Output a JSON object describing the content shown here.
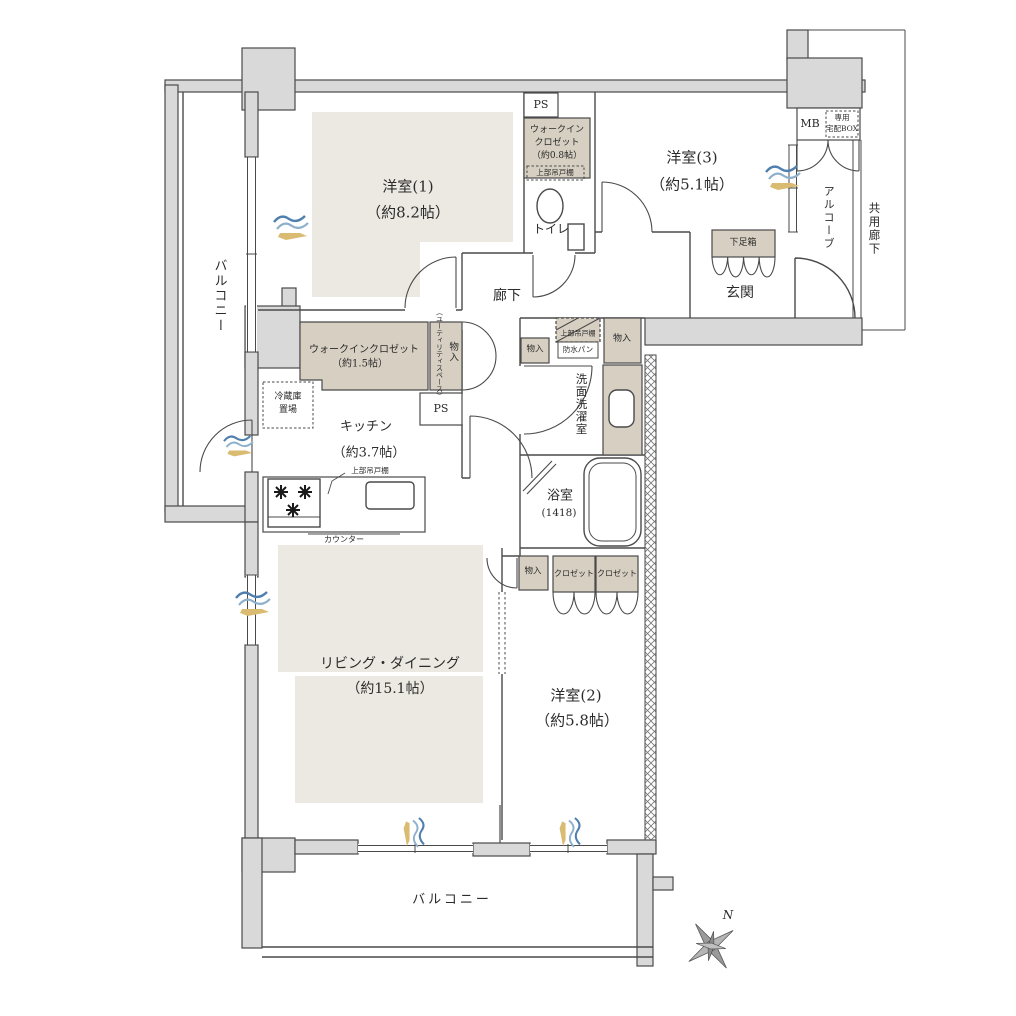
{
  "floorplan": {
    "balcony_left": "バルコニー",
    "balcony_bottom": "バルコニー",
    "yoshitsu1_name": "洋室(1)",
    "yoshitsu1_size": "（約8.2帖）",
    "yoshitsu2_name": "洋室(2)",
    "yoshitsu2_size": "（約5.8帖）",
    "yoshitsu3_name": "洋室(3)",
    "yoshitsu3_size": "（約5.1帖）",
    "living_name": "リビング・ダイニング",
    "living_size": "（約15.1帖）",
    "kitchen_name": "キッチン",
    "kitchen_size": "（約3.7帖）",
    "wic08_l1": "ウォークイン",
    "wic08_l2": "クロゼット",
    "wic08_l3": "（約0.8帖）",
    "wic15_l1": "ウォークインクロゼット",
    "wic15_l2": "（約1.5帖）",
    "toilet": "トイレ",
    "hallway": "廊下",
    "genkan": "玄関",
    "getabako": "下足箱",
    "washroom": "洗面洗濯室",
    "bath_name": "浴室",
    "bath_size": "(1418)",
    "ps_top": "PS",
    "ps_mid": "PS",
    "mb": "MB",
    "takuhai_l1": "専用",
    "takuhai_l2": "宅配BOX",
    "alcove": "アルコーブ",
    "shared_corridor": "共用廊下",
    "monoiri_utility": "物入",
    "utility_note": "（ユーティリティスペース）",
    "reizouko_l1": "冷蔵庫",
    "reizouko_l2": "置場",
    "shelf_toilet": "上部吊戸棚",
    "shelf_kitchen": "上部吊戸棚",
    "shelf_wash": "上部吊戸棚",
    "bousui": "防水パン",
    "counter": "カウンター",
    "monoiri_wash_left": "物入",
    "monoiri_wash_right": "物入",
    "monoiri_ld": "物入",
    "closet1": "クロゼット",
    "closet2": "クロゼット",
    "compass_n": "N"
  },
  "colors": {
    "wall_fill": "#d9d9d9",
    "wall_line": "#4a4a4a",
    "closet_fill": "#d6cfc2",
    "carpet_fill": "#ece9e2",
    "wave_blue_dark": "#4e7fae",
    "wave_blue_light": "#8cb0cc",
    "wave_tan": "#d9bb72",
    "text": "#2b2b2b"
  }
}
